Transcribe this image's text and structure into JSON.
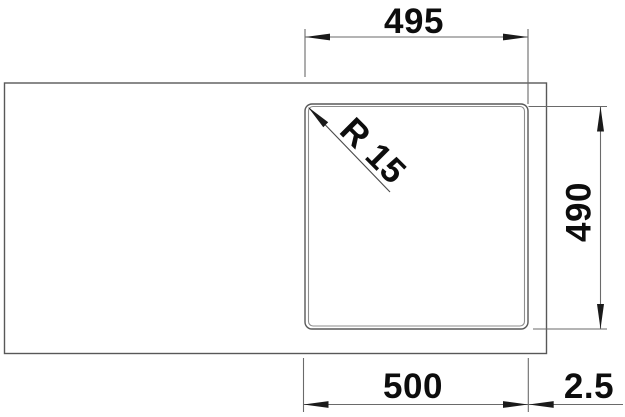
{
  "drawing": {
    "description": "Technical top-view dimension drawing of a kitchen sink with a square bowl on the right side",
    "labels": {
      "width_top": "495",
      "height_right": "490",
      "width_bottom": "500",
      "edge_offset": "2.5",
      "corner_radius": "R 15"
    },
    "dimensions_mm": {
      "bowl_cutout_width": 495,
      "bowl_cutout_height": 490,
      "bowl_overall_width": 500,
      "edge_offset": 2.5,
      "bowl_corner_radius": 15
    },
    "colors": {
      "background": "#ffffff",
      "outline": "#585858",
      "inner_edge": "#8e8e8e",
      "dimension_line": "#6a6a6a",
      "arrow": "#1a1a1a",
      "text": "#0d0d0d"
    }
  }
}
